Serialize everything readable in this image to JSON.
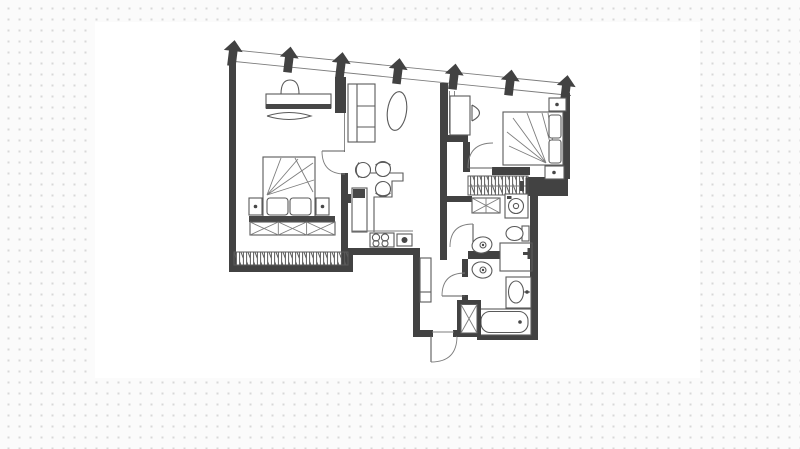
{
  "canvas": {
    "background": "#fbfbfb",
    "dot_color": "#d8d8d8",
    "plan_sheet_color": "#ffffff",
    "wall_color": "#424242",
    "line_color": "#5a5a5a",
    "soft_line_color": "#7d7d7d",
    "dark_fill": "#474747"
  },
  "floorplan": {
    "kind": "monochrome apartment floor plan, top view, no text labels",
    "facade": {
      "style": "slanted double line glazing along the top",
      "arrow_icon": "solid-up-arrow",
      "arrow_count": 7
    },
    "door_count": 5,
    "rooms": [
      {
        "name": "bedroom-left",
        "furniture": [
          "desk",
          "desk-chair",
          "double-bed",
          "pillows",
          "nightstand-left",
          "nightstand-right",
          "blanket-chest-x",
          "hanging-rail-wardrobe"
        ]
      },
      {
        "name": "living-kitchen",
        "furniture": [
          "shelf-sofa",
          "oval-rug",
          "dining-table",
          "dining-chair-1",
          "dining-chair-2",
          "dining-chair-3",
          "kitchen-island",
          "cooktop-4-burner",
          "kitchen-sink"
        ]
      },
      {
        "name": "bedroom-right",
        "furniture": [
          "dressing-table",
          "stool",
          "double-bed",
          "pillows",
          "nightstand-top",
          "nightstand-bottom",
          "radiator",
          "closet-rail"
        ]
      },
      {
        "name": "bathroom-top",
        "furniture": [
          "x-cabinet",
          "washing-machine",
          "toilet",
          "wash-basin"
        ]
      },
      {
        "name": "bathroom-bottom",
        "furniture": [
          "toilet",
          "wash-basin-counter",
          "shower-mixer",
          "bathtub"
        ]
      },
      {
        "name": "hallway",
        "furniture": [
          "console-cabinet",
          "duct-shaft-x",
          "entry-door"
        ]
      }
    ]
  }
}
